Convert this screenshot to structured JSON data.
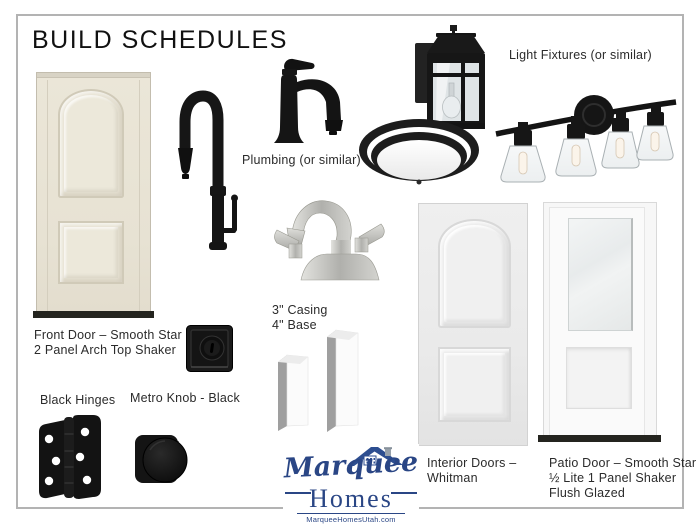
{
  "page": {
    "title": "BUILD SCHEDULES",
    "background": "#ffffff",
    "border_color": "#b3b3b3"
  },
  "labels": {
    "front_door_1": "Front Door – Smooth Star",
    "front_door_2": "2 Panel Arch Top Shaker",
    "plumbing": "Plumbing (or similar)",
    "light_fixtures": "Light Fixtures (or similar)",
    "casing": "3\" Casing",
    "base": "4\" Base",
    "black_hinges": "Black Hinges",
    "metro_knob": "Metro Knob - Black",
    "interior_doors_1": "Interior Doors –",
    "interior_doors_2": "Whitman",
    "patio_door_1": "Patio Door – Smooth Star",
    "patio_door_2": "½ Lite 1 Panel Shaker",
    "patio_door_3": "Flush Glazed"
  },
  "logo": {
    "name_script": "Marquee",
    "name_serif": "Homes",
    "website": "MarqueeHomesUtah.com",
    "navy": "#2a4685"
  },
  "images": [
    "front-door",
    "kitchen-faucet-black",
    "bath-faucet-black",
    "bath-faucet-nickel",
    "outdoor-wall-lantern",
    "flush-mount-ceiling-light",
    "vanity-bar-light-4",
    "casing-and-base-trim",
    "square-deadbolt-black",
    "door-hinge-black",
    "metro-knob-black",
    "interior-door-whitman",
    "patio-door-half-lite"
  ],
  "colors": {
    "door_cream": "#e9e4d6",
    "fixture_black": "#171717",
    "nickel": "#c6c6c2",
    "interior_door_gray": "#ececec",
    "accent_navy": "#2a4685"
  }
}
